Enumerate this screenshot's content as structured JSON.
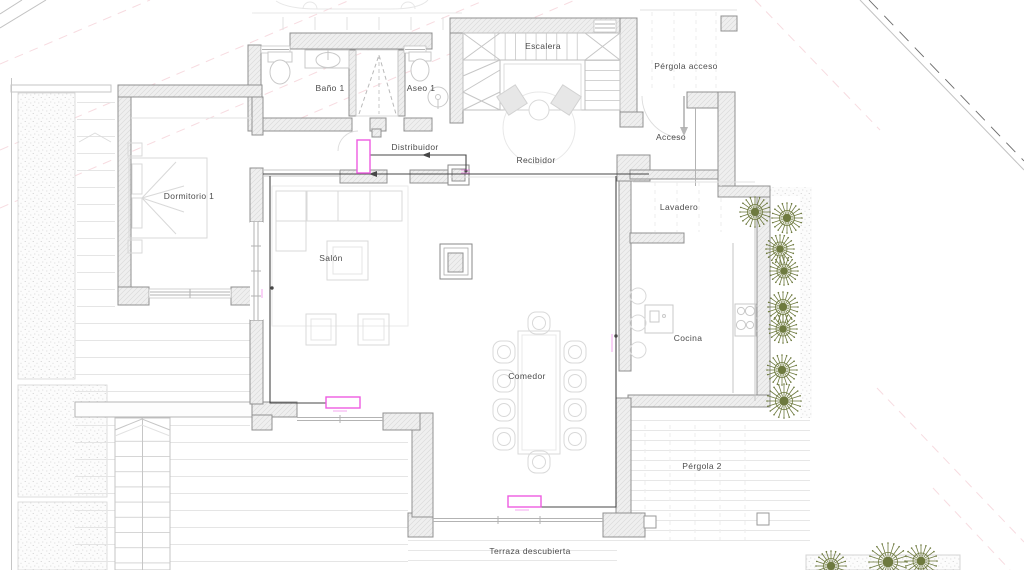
{
  "rooms": {
    "bano1": {
      "label": "Baño 1"
    },
    "aseo1": {
      "label": "Aseo 1"
    },
    "escalera": {
      "label": "Escalera"
    },
    "pergola_acceso": {
      "label": "Pérgola acceso"
    },
    "acceso": {
      "label": "Acceso"
    },
    "distribuidor": {
      "label": "Distribuidor"
    },
    "recibidor": {
      "label": "Recibidor"
    },
    "dormitorio1": {
      "label": "Dormitorio 1"
    },
    "lavadero": {
      "label": "Lavadero"
    },
    "salon": {
      "label": "Salón"
    },
    "cocina": {
      "label": "Cocina"
    },
    "comedor": {
      "label": "Comedor"
    },
    "pergola2": {
      "label": "Pérgola 2"
    },
    "terraza": {
      "label": "Terraza descubierta"
    }
  },
  "colors": {
    "radiator_accent": "#ee5ce2",
    "plant_green": "#6e7a3f",
    "wall_outline": "#909090",
    "setback_pink": "#f2c3cc",
    "pipe_dark": "#474747"
  },
  "icons": {
    "plant": "plant-icon",
    "radiator": "radiator-icon",
    "stair": "staircase-icon"
  }
}
